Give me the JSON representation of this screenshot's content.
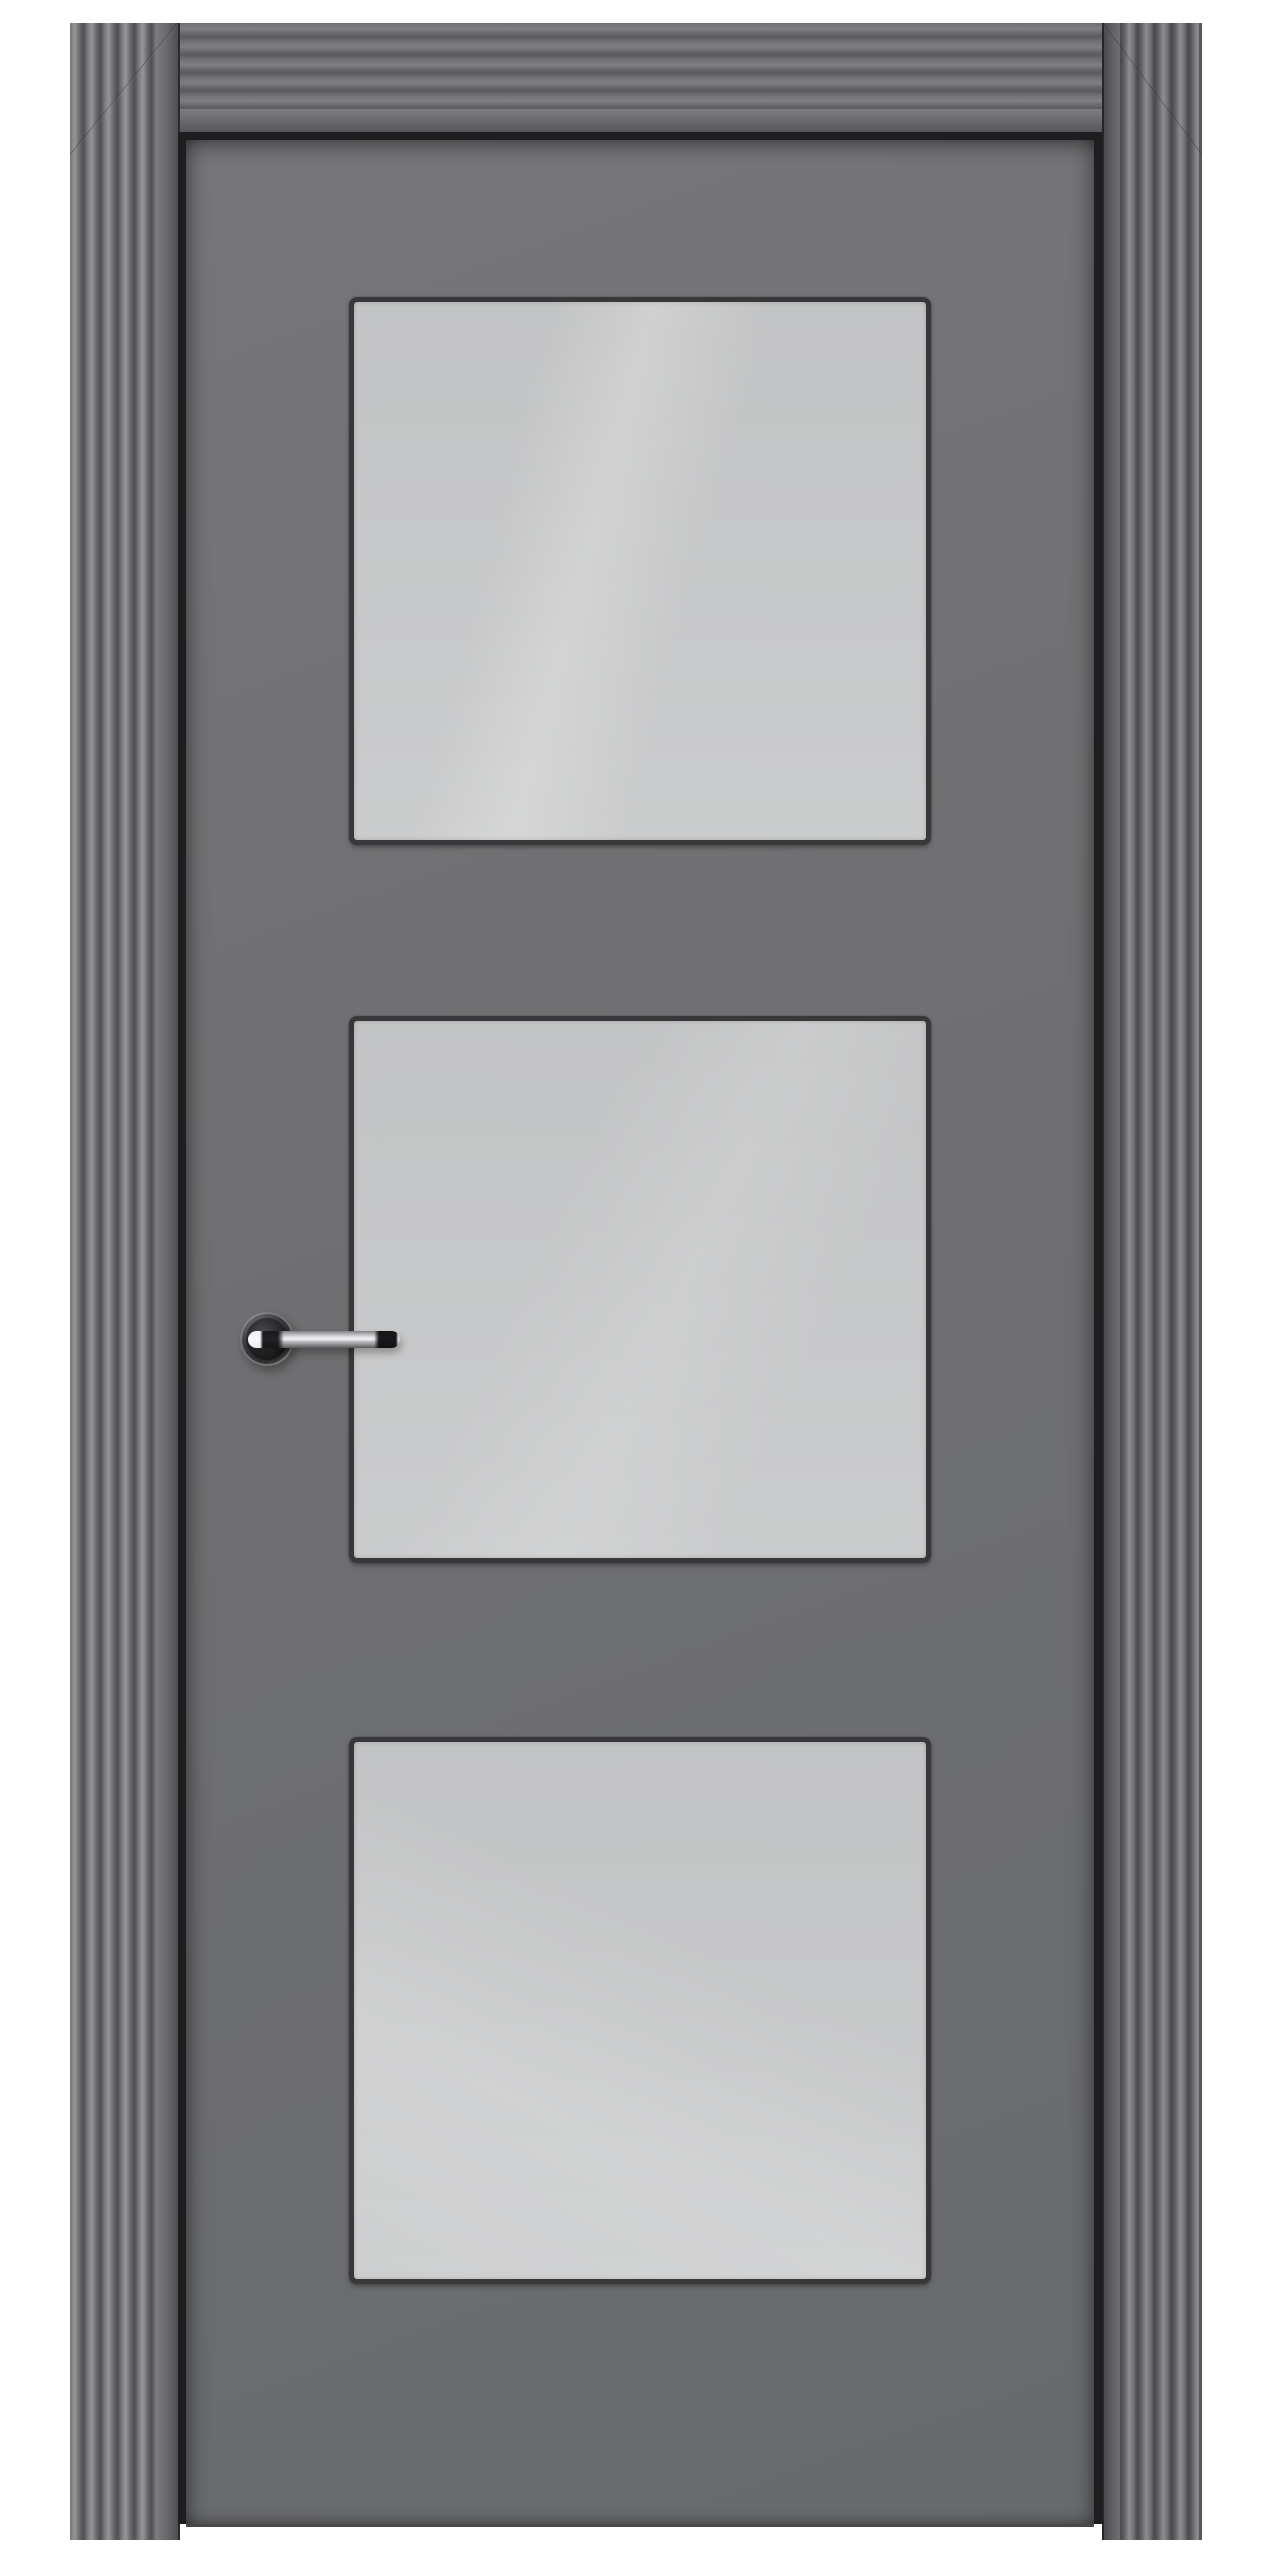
{
  "scene": {
    "title": "Gray interior door with three square frosted glass panels and a polished chrome lever handle, shown closed in a fluted gray architrave frame on a white background",
    "object_type": "interior door product render",
    "text_content": "none",
    "colors": {
      "background": "#ffffff",
      "door": "#6f6f71",
      "frame": "#666668",
      "frame_ridge_light": "#8c8c8e",
      "frame_ridge_dark": "#4b4b4d",
      "reveal": "#1e1e20",
      "bead": "#38383a",
      "glass": "#c6c7c8",
      "glass_highlight": "#d0d1d2",
      "chrome_light": "#f1f2f3",
      "chrome_dark": "#1c1c1e"
    },
    "frame": {
      "outer_left": 70,
      "outer_top": 23,
      "outer_right": 1202,
      "outer_bottom": 2540,
      "side_width": 108,
      "right_side_width": 100,
      "top_height": 109,
      "flute_width": 86,
      "jamb_width": 22,
      "top_flute_height": 86,
      "top_jamb_height": 23
    },
    "reveal_rect": {
      "left": 178,
      "top": 132,
      "right": 1102,
      "bottom": 2524
    },
    "door_rect": {
      "left": 186,
      "top": 140,
      "width": 908,
      "height": 2384
    },
    "panel_left": 349,
    "panel_width": 582,
    "panels": [
      {
        "label": "top glass panel",
        "top": 297,
        "height": 548
      },
      {
        "label": "middle glass panel",
        "top": 1016,
        "height": 547
      },
      {
        "label": "bottom glass panel",
        "top": 1737,
        "height": 547
      }
    ],
    "handle": {
      "finish": "polished chrome",
      "rose": {
        "cx": 267,
        "cy": 1339,
        "r": 27
      },
      "lever": {
        "left": 248,
        "top": 1331,
        "width": 152,
        "height": 17
      }
    }
  }
}
